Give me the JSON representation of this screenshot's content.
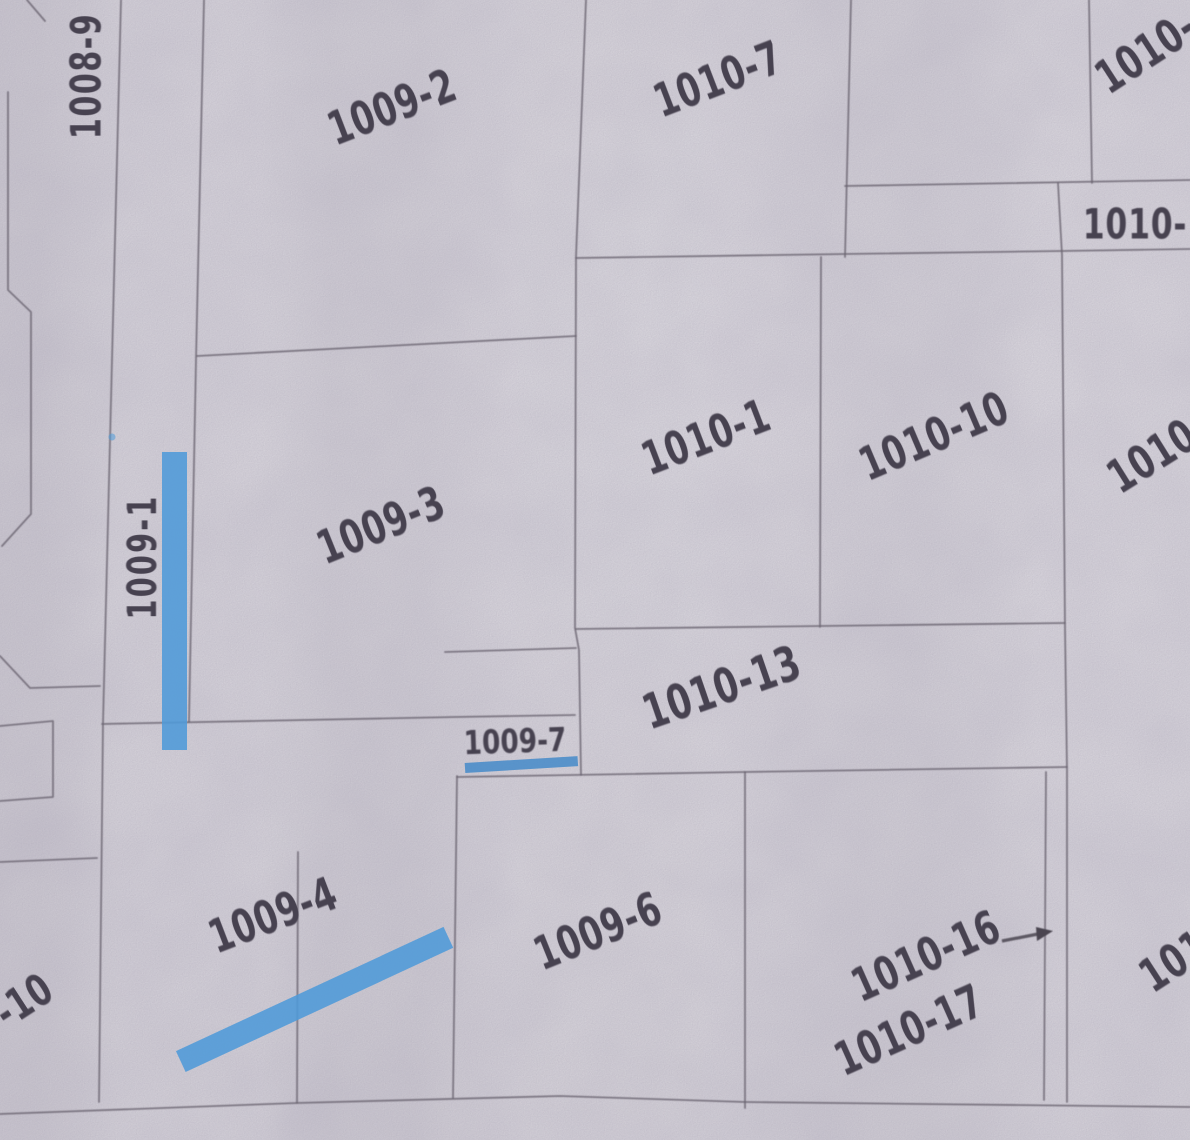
{
  "document": {
    "type": "cadastral-parcel-map-scan",
    "description": "Scanned Japanese cadastral (land parcel) map with parcel numbers; three parcels marked with blue highlighter"
  },
  "colors": {
    "paper": "#d9d6dd",
    "boundary_line": "#6a6470",
    "label_text": "#474250",
    "highlight_blue": "#4e9ad8",
    "underline_blue": "#3f87c8"
  },
  "parcels": [
    {
      "id": "1008-9",
      "text": "1008-9",
      "orientation": "vertical"
    },
    {
      "id": "1009-2",
      "text": "1009-2",
      "orientation": "tilted"
    },
    {
      "id": "1010-7",
      "text": "1010-7",
      "orientation": "tilted"
    },
    {
      "id": "1010-top-right-cut",
      "text": "1010-",
      "orientation": "tilted",
      "note": "clipped by image edge"
    },
    {
      "id": "1010-strip-cut",
      "text": "1010-",
      "orientation": "horizontal",
      "note": "clipped by image edge"
    },
    {
      "id": "1010-1",
      "text": "1010-1",
      "orientation": "tilted"
    },
    {
      "id": "1010-10",
      "text": "1010-10",
      "orientation": "tilted"
    },
    {
      "id": "1010-right-cut",
      "text": "1010",
      "orientation": "tilted",
      "note": "clipped by image edge"
    },
    {
      "id": "1009-1",
      "text": "1009-1",
      "orientation": "vertical",
      "highlight": "vertical-stripe"
    },
    {
      "id": "1009-3",
      "text": "1009-3",
      "orientation": "tilted"
    },
    {
      "id": "1010-13",
      "text": "1010-13",
      "orientation": "tilted"
    },
    {
      "id": "1009-7",
      "text": "1009-7",
      "orientation": "horizontal",
      "highlight": "underline"
    },
    {
      "id": "-10",
      "text": "-10",
      "orientation": "tilted",
      "note": "clipped by image edge"
    },
    {
      "id": "1009-4",
      "text": "1009-4",
      "orientation": "tilted",
      "highlight": "diagonal-stripe"
    },
    {
      "id": "1009-6",
      "text": "1009-6",
      "orientation": "tilted"
    },
    {
      "id": "1010-16",
      "text": "1010-16",
      "orientation": "tilted",
      "note": "arrow points to narrow sliver parcel"
    },
    {
      "id": "1010-17",
      "text": "1010-17",
      "orientation": "tilted"
    },
    {
      "id": "101-bottom-right-cut",
      "text": "101",
      "orientation": "tilted",
      "note": "clipped by image edge"
    }
  ],
  "annotations": {
    "highlighter_marks": [
      {
        "type": "vertical-stripe",
        "parcel": "1009-1",
        "color": "#4e9ad8"
      },
      {
        "type": "diagonal-stripe",
        "parcel": "1009-4",
        "color": "#4e9ad8"
      },
      {
        "type": "underline",
        "parcel": "1009-7",
        "color": "#3f87c8"
      },
      {
        "type": "dot",
        "near": "1009-1",
        "color": "#4e9ad8"
      }
    ],
    "arrow": {
      "from": "1010-16",
      "points_to": "narrow sliver parcel on its right"
    }
  }
}
